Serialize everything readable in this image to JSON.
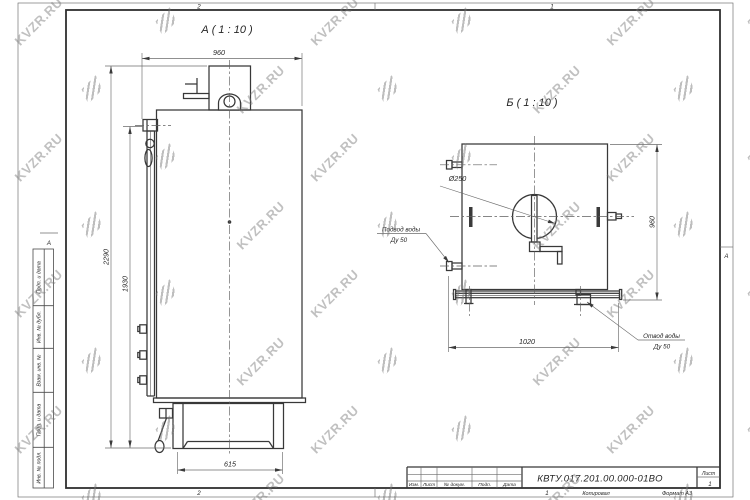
{
  "frame": {
    "zone_top_left": "2",
    "zone_top_right": "1",
    "zone_bottom_left": "2",
    "zone_bottom_right": "1",
    "zone_row_left": "А",
    "zone_row_right": "А",
    "margin_cells": [
      "Подп. и дата",
      "Инв. № дубл.",
      "Взам. инв. №",
      "Подп. и дата",
      "Инв. № подл."
    ]
  },
  "views": {
    "front": {
      "title": "А ( 1 : 10 )",
      "dim_width_top": "960",
      "dim_height_overall": "2290",
      "dim_height_body": "1930",
      "dim_base_width": "615"
    },
    "side": {
      "title": "Б ( 1 : 10 )",
      "dim_diameter": "Ø250",
      "dim_height": "960",
      "dim_base_width": "1020",
      "inlet_line1": "Подвод воды",
      "inlet_line2": "Ду 50",
      "outlet_line1": "Отвод воды",
      "outlet_line2": "Ду 50"
    }
  },
  "title_block": {
    "doc_number": "КВТУ.017.201.00.000-01ВО",
    "columns": [
      "Изм.",
      "Лист",
      "№ докум.",
      "Подп.",
      "Дата"
    ],
    "sheet_label": "Лист",
    "sheet_number": "1",
    "copied_label": "Копировал",
    "format_label": "Формат А3"
  },
  "watermark": {
    "text": "KVZR.RU"
  }
}
